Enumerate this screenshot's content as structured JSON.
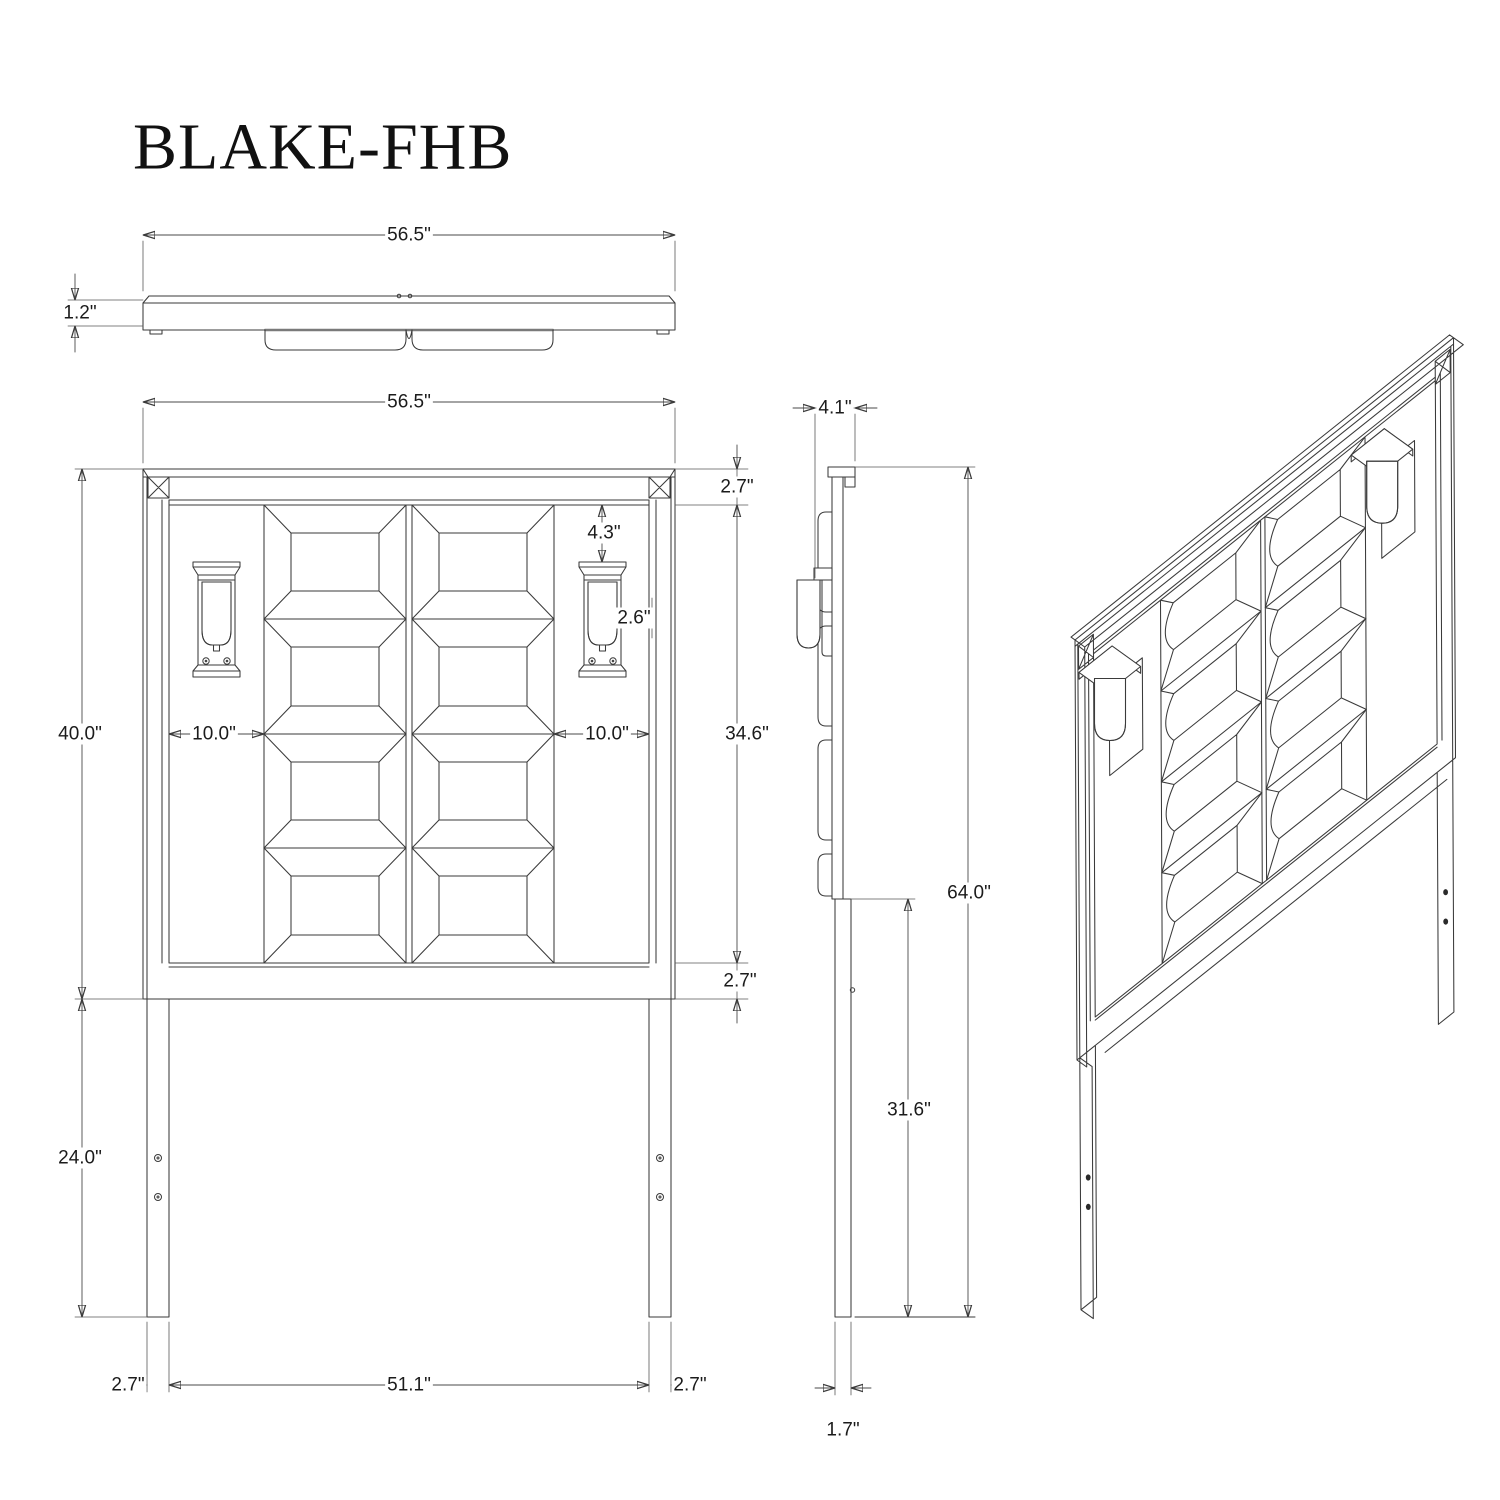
{
  "title": "BLAKE-FHB",
  "top_view": {
    "width": "56.5\"",
    "thickness": "1.2\""
  },
  "front_view": {
    "width": "56.5\"",
    "top_rail_height": "2.7\"",
    "lamp_top_offset": "4.3\"",
    "lamp_width": "2.6\"",
    "left_panel_inset": "10.0\"",
    "right_panel_inset": "10.0\"",
    "board_height": "40.0\"",
    "panel_field_height": "34.6\"",
    "bottom_rail_height": "2.7\"",
    "leg_length": "24.0\"",
    "left_leg_width": "2.7\"",
    "inner_span": "51.1\"",
    "right_leg_width": "2.7\""
  },
  "side_view": {
    "depth": "4.1\"",
    "total_height": "64.0\"",
    "upper_leg_height": "31.6\"",
    "leg_thickness": "1.7\""
  }
}
